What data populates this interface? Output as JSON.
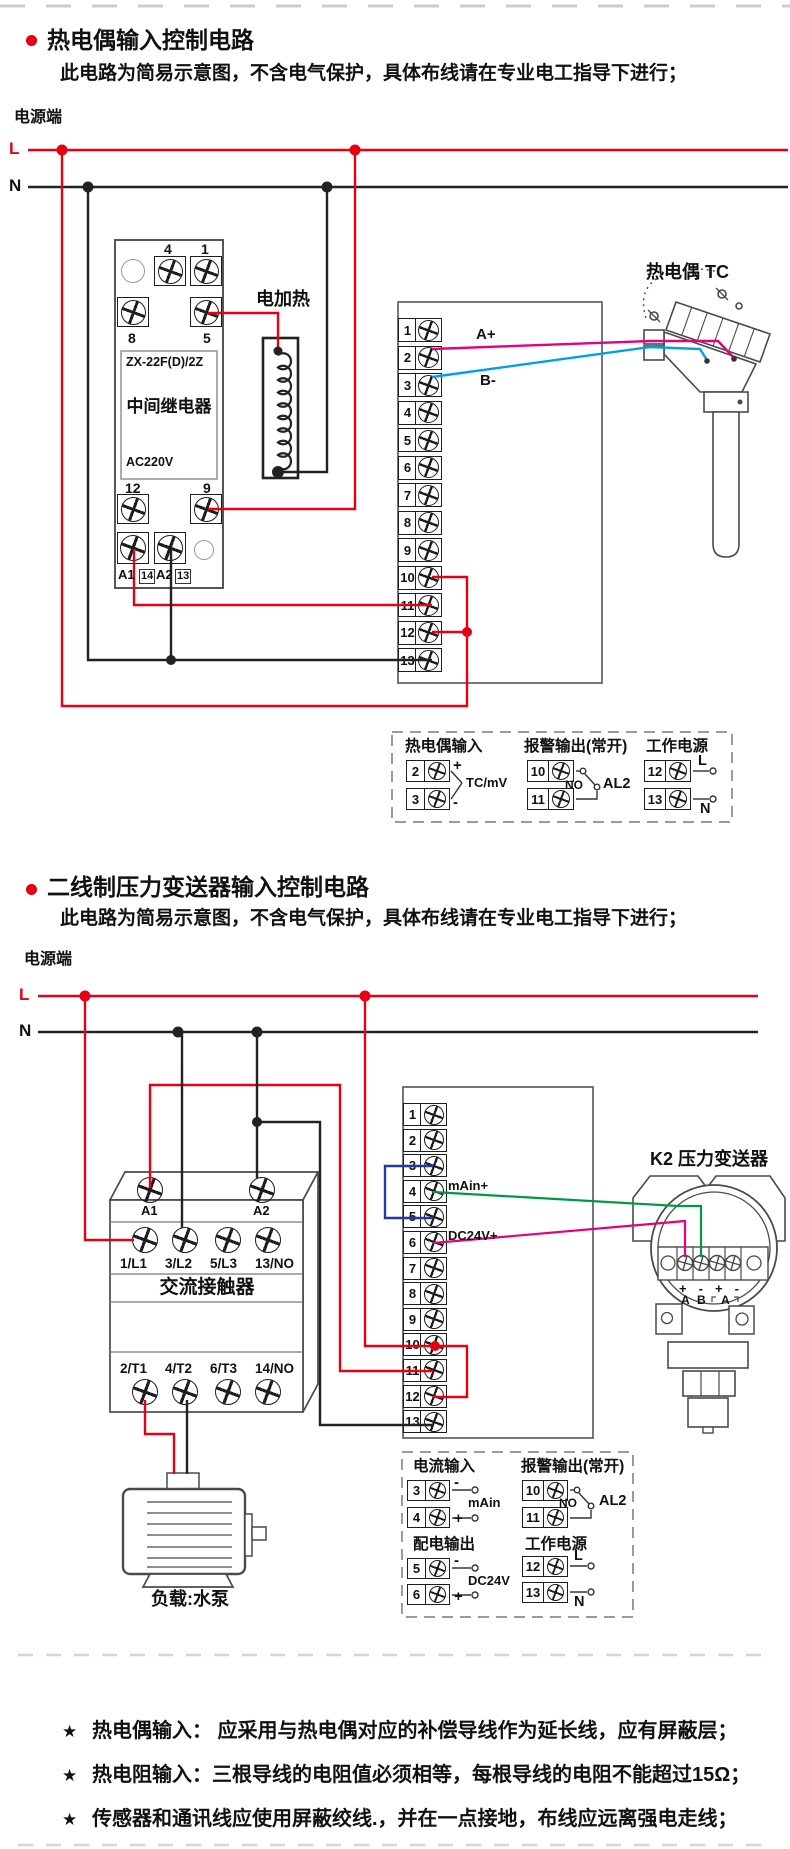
{
  "colors": {
    "accent_red": "#e60012",
    "wire_black": "#222222",
    "wire_magenta": "#e4007f",
    "wire_blue": "#00a0e9",
    "wire_green": "#009944",
    "wire_navy": "#2438a5",
    "outline": "#4a4a4a",
    "dash_gray": "#cccccc"
  },
  "section1": {
    "title": "热电偶输入控制电路",
    "subtitle": "此电路为简易示意图，不含电气保护，具体布线请在专业电工指导下进行；",
    "power_label": "电源端",
    "l": "L",
    "n": "N",
    "relay": {
      "t4": "4",
      "t1": "1",
      "t8": "8",
      "t5": "5",
      "model": "ZX-22F(D)/2Z",
      "name": "中间继电器",
      "voltage": "AC220V",
      "t12": "12",
      "t9": "9",
      "a1": "A1",
      "t14": "14",
      "a2": "A2",
      "t13": "13"
    },
    "heater_label": "电加热",
    "tc_label": "热电偶 TC",
    "wire_a": "A+",
    "wire_b": "B-",
    "terminals": [
      "1",
      "2",
      "3",
      "4",
      "5",
      "6",
      "7",
      "8",
      "9",
      "10",
      "11",
      "12",
      "13"
    ],
    "legend": {
      "g1_title": "热电偶输入",
      "g1_t1": "2",
      "g1_t2": "3",
      "g1_plus": "+",
      "g1_minus": "-",
      "g1_label": "TC/mV",
      "g2_title": "报警输出(常开)",
      "g2_t1": "10",
      "g2_t2": "11",
      "g2_no": "NO",
      "g2_label": "AL2",
      "g3_title": "工作电源",
      "g3_t1": "12",
      "g3_t2": "13",
      "g3_l": "L",
      "g3_n": "N"
    }
  },
  "section2": {
    "title": "二线制压力变送器输入控制电路",
    "subtitle": "此电路为简易示意图，不含电气保护，具体布线请在专业电工指导下进行；",
    "power_label": "电源端",
    "l": "L",
    "n": "N",
    "contactor": {
      "a1": "A1",
      "a2": "A2",
      "name": "交流接触器",
      "top": [
        "1/L1",
        "3/L2",
        "5/L3",
        "13/NO"
      ],
      "bottom": [
        "2/T1",
        "4/T2",
        "6/T3",
        "14/NO"
      ]
    },
    "load_label": "负载:水泵",
    "transmitter": {
      "label": "K2 压力变送器",
      "signs": [
        "+",
        "-",
        "+",
        "-"
      ],
      "a": "A",
      "b": "B",
      "meter": "A"
    },
    "wire_main": "mAin+",
    "wire_dc": "DC24V+",
    "terminals": [
      "1",
      "2",
      "3",
      "4",
      "5",
      "6",
      "7",
      "8",
      "9",
      "10",
      "11",
      "12",
      "13"
    ],
    "legend": {
      "g1_title": "电流输入",
      "g1_t1": "3",
      "g1_t2": "4",
      "g1_minus": "-",
      "g1_plus": "+",
      "g1_label": "mAin",
      "g2_title": "报警输出(常开)",
      "g2_t1": "10",
      "g2_t2": "11",
      "g2_no": "NO",
      "g2_label": "AL2",
      "g3_title": "配电输出",
      "g3_t1": "5",
      "g3_t2": "6",
      "g3_minus": "-",
      "g3_plus": "+",
      "g3_label": "DC24V",
      "g4_title": "工作电源",
      "g4_t1": "12",
      "g4_t2": "13",
      "g4_l": "L",
      "g4_n": "N"
    }
  },
  "footnotes": {
    "star": "★",
    "items": [
      "热电偶输入： 应采用与热电偶对应的补偿导线作为延长线，应有屏蔽层；",
      "热电阻输入：三根导线的电阻值必须相等，每根导线的电阻不能超过15Ω；",
      "传感器和通讯线应使用屏蔽绞线.，并在一点接地，布线应远离强电走线；"
    ]
  }
}
